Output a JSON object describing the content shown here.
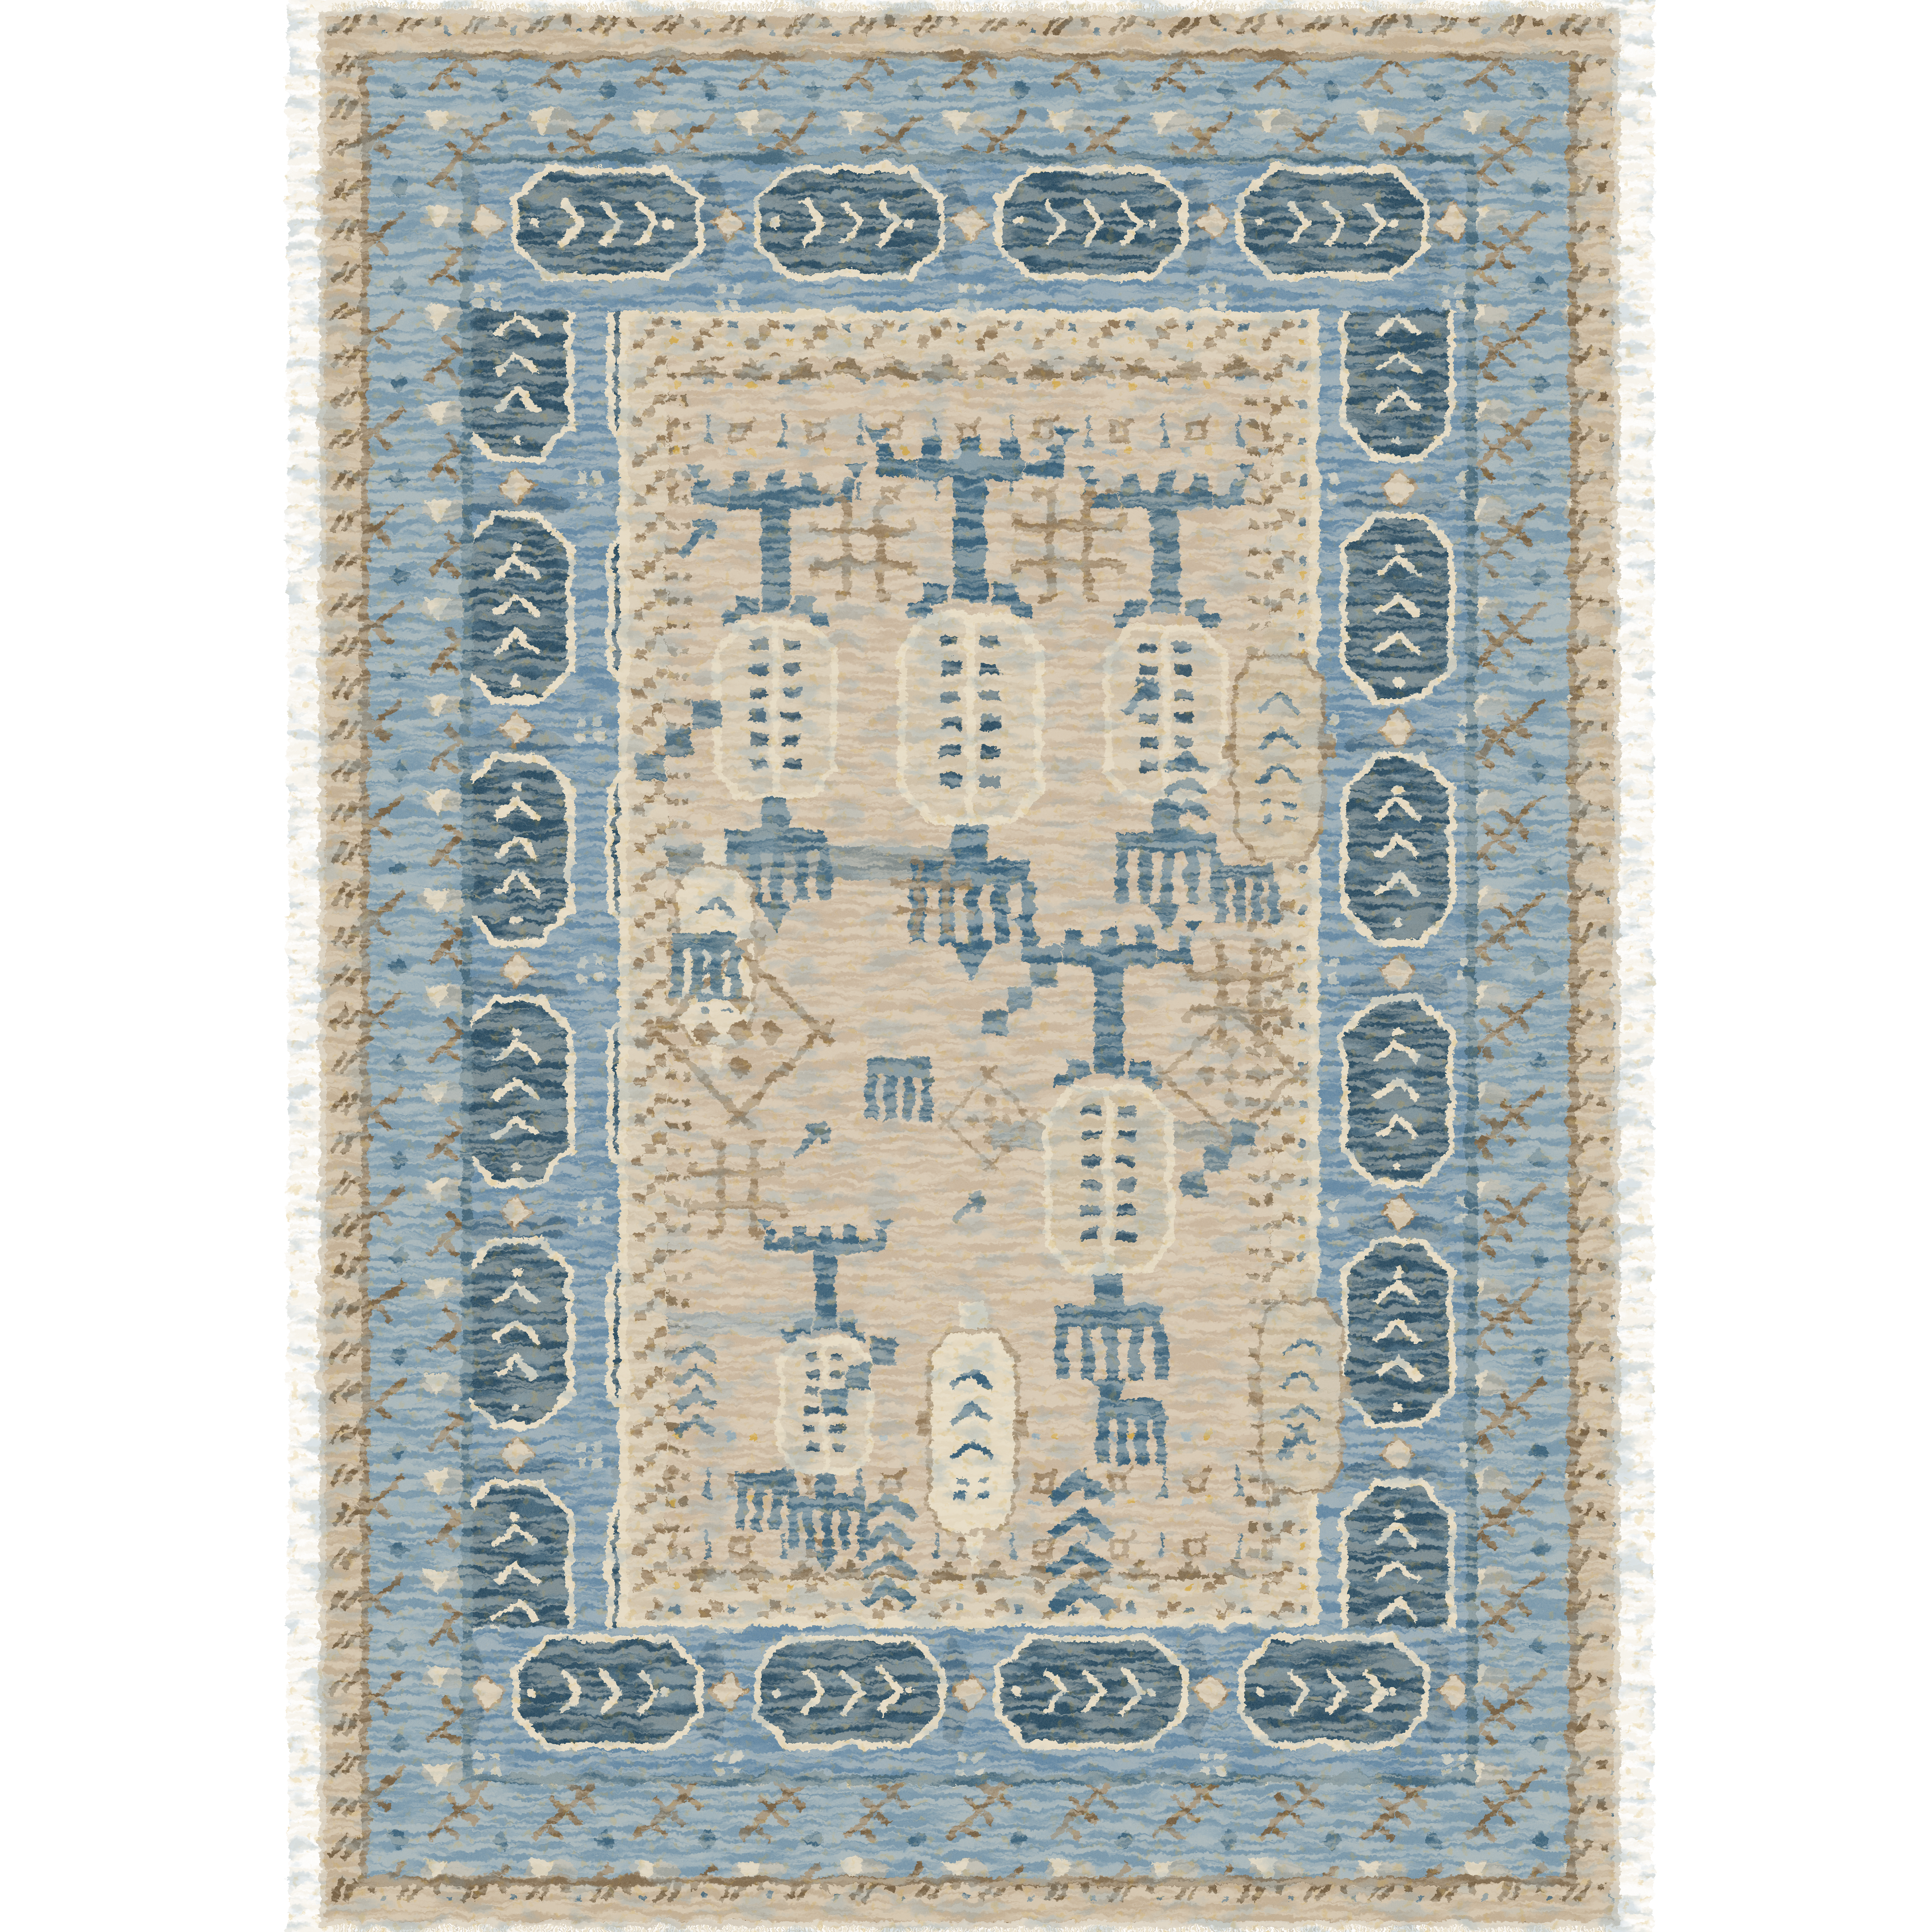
{
  "scene": {
    "type": "product-photo",
    "subject": "oriental-tribal-area-rug",
    "orientation": "portrait",
    "background": "#ffffff"
  },
  "colors": {
    "bg": "#ffffff",
    "fringe": "#e8dfc9",
    "selvage": "#d3cabb",
    "field": "#c6b29a",
    "tan": "#bfab90",
    "tan_l": "#cdbea6",
    "tan_d": "#9c8668",
    "cream": "#e2d6bd",
    "ivory": "#efe7d6",
    "brown": "#8a7050",
    "brown2": "#6c5639",
    "blue_g": "#7292a7",
    "bblue": "#5c82a0",
    "steel": "#84a2b4",
    "navy": "#2b5570",
    "navy2": "#1f4259",
    "gold": "#cfa02f"
  },
  "rug": {
    "x": 732,
    "y": 18,
    "w": 3010,
    "h": 4436,
    "fringe": {
      "h": 28,
      "strand_w": 5
    },
    "bands": [
      {
        "name": "outer-edge",
        "a": 0,
        "b": 14,
        "fill": "@selvage"
      },
      {
        "name": "outer-chain",
        "a": 14,
        "b": 96,
        "fill": "url(#pA)"
      },
      {
        "name": "guard-brown",
        "a": 96,
        "b": 116,
        "fill": "@brown2",
        "o": 0.85
      },
      {
        "name": "branch-border",
        "a": 116,
        "b": 330,
        "fill": "url(#pB)"
      },
      {
        "name": "guard-navy",
        "a": 330,
        "b": 354,
        "fill": "@navy",
        "o": 0.9
      },
      {
        "name": "main-border",
        "a": 354,
        "b": 694,
        "fill": "url(#pC)",
        "fillTB": "url(#pCh)"
      },
      {
        "name": "guard-cream",
        "a": 694,
        "b": 716,
        "fill": "@cream",
        "o": 0.9
      },
      {
        "name": "inner-border",
        "a": 716,
        "b": 806,
        "fill": "url(#pD)"
      },
      {
        "name": "pyramid-row",
        "a": 806,
        "b": 858,
        "fill": "url(#pPyr)",
        "o": 0.9
      }
    ],
    "row_zones": [
      {
        "x": 1538,
        "y": 870,
        "w": 1398,
        "h": 280,
        "o": 0.95
      },
      {
        "x": 1538,
        "y": 3310,
        "w": 1398,
        "h": 290,
        "o": 0.95
      }
    ],
    "accents": [
      {
        "x": 1538,
        "y": 1950,
        "w": 680,
        "h": 78,
        "fill": "@navy",
        "o": 0.5
      },
      {
        "x": 2290,
        "y": 2592,
        "w": 600,
        "h": 62,
        "fill": "@navy",
        "o": 0.35
      },
      {
        "x": 1538,
        "y": 3030,
        "w": 430,
        "h": 58,
        "fill": "@blue_g",
        "o": 0.5
      }
    ],
    "motifs": [
      {
        "ref": "totem",
        "x": 2240,
        "y": 975,
        "s": 1.12
      },
      {
        "ref": "totem",
        "x": 1788,
        "y": 1060,
        "s": 0.95,
        "o": 0.92
      },
      {
        "ref": "totem",
        "x": 2692,
        "y": 1065,
        "s": 0.95,
        "o": 0.9
      },
      {
        "ref": "totem",
        "x": 2560,
        "y": 2115,
        "s": 1.0,
        "o": 0.95,
        "style": "--cart-fill:#c8b79c"
      },
      {
        "ref": "totem",
        "x": 1905,
        "y": 2810,
        "s": 0.72,
        "o": 0.95
      },
      {
        "ref": "bottle",
        "x": 2245,
        "y": 3005,
        "s": 0.85
      },
      {
        "ref": "bottle",
        "x": 3005,
        "y": 2940,
        "s": 0.8,
        "o": 0.9,
        "style": "--bottle-fill:#c3b195;--bottle-stroke:#8a7050"
      },
      {
        "ref": "bottle",
        "x": 2955,
        "y": 1440,
        "s": 0.85,
        "o": 0.9,
        "style": "--bottle-fill:#c3b195;--bottle-stroke:#8a7050"
      },
      {
        "ref": "bottle",
        "x": 1650,
        "y": 1935,
        "s": 0.75,
        "o": 0.85
      },
      {
        "ref": "cross",
        "x": 2468,
        "y": 1255,
        "s": 0.92
      },
      {
        "ref": "cross",
        "x": 1992,
        "y": 1262,
        "s": 0.85,
        "o": 0.9
      },
      {
        "ref": "cross",
        "x": 2862,
        "y": 2292,
        "s": 0.88,
        "o": 0.9
      },
      {
        "ref": "cross",
        "x": 1700,
        "y": 2745,
        "s": 0.8,
        "o": 0.85
      },
      {
        "ref": "cross",
        "x": 2152,
        "y": 2070,
        "s": 0.65,
        "o": 0.75
      },
      {
        "ref": "lattice",
        "x": 1705,
        "y": 2385,
        "s": 1.0
      },
      {
        "ref": "lattice",
        "x": 2845,
        "y": 2480,
        "s": 0.8,
        "o": 0.8
      },
      {
        "ref": "lattice",
        "x": 2285,
        "y": 2585,
        "s": 0.55,
        "o": 0.7
      },
      {
        "ref": "comb",
        "x": 1625,
        "y": 2175,
        "s": 0.9,
        "o": 0.9
      },
      {
        "ref": "comb",
        "x": 2880,
        "y": 2015,
        "s": 0.8,
        "o": 0.85
      },
      {
        "ref": "comb",
        "x": 2072,
        "y": 2465,
        "s": 0.85,
        "o": 0.9
      },
      {
        "ref": "comb",
        "x": 2610,
        "y": 3255,
        "s": 0.9
      },
      {
        "ref": "comb",
        "x": 1768,
        "y": 3420,
        "s": 0.8,
        "o": 0.9
      },
      {
        "ref": "chev",
        "x": 2495,
        "y": 3425,
        "s": 1.05
      },
      {
        "ref": "chev",
        "x": 2052,
        "y": 3470,
        "s": 0.85,
        "o": 0.9
      },
      {
        "ref": "chev",
        "x": 2742,
        "y": 1752,
        "s": 0.7,
        "o": 0.8
      },
      {
        "ref": "chev",
        "x": 1606,
        "y": 3115,
        "s": 0.7,
        "o": 0.8
      },
      {
        "ref": "arrow",
        "x": 1585,
        "y": 1215,
        "s": 1.0
      },
      {
        "ref": "arrow",
        "x": 2615,
        "y": 1585,
        "s": 0.9,
        "o": 0.85
      },
      {
        "ref": "arrow",
        "x": 1852,
        "y": 2612,
        "s": 0.9,
        "o": 0.8
      },
      {
        "ref": "arrow",
        "x": 2968,
        "y": 3312,
        "s": 0.9,
        "o": 0.85
      },
      {
        "ref": "arrow",
        "x": 2222,
        "y": 2772,
        "s": 0.8,
        "o": 0.75
      },
      {
        "ref": "steps",
        "x": 1565,
        "y": 1705,
        "s": 1.0,
        "o": 0.85
      },
      {
        "ref": "steps",
        "x": 2352,
        "y": 2302,
        "s": 0.9,
        "o": 0.8
      },
      {
        "ref": "steps",
        "x": 2815,
        "y": 2672,
        "s": 0.9,
        "o": 0.8
      },
      {
        "ref": "steps",
        "x": 1982,
        "y": 3175,
        "s": 0.9,
        "o": 0.85
      }
    ]
  },
  "overlays": [
    {
      "filter": "mIvory",
      "fill": "@ivory",
      "o": 0.42
    },
    {
      "filter": "mBlue",
      "fill": "@steel",
      "o": 0.3
    },
    {
      "filter": "mGold",
      "fill": "@gold",
      "o": 0.22
    },
    {
      "filter": "mGrain",
      "fill": "@ivory",
      "o": 0.2
    }
  ]
}
